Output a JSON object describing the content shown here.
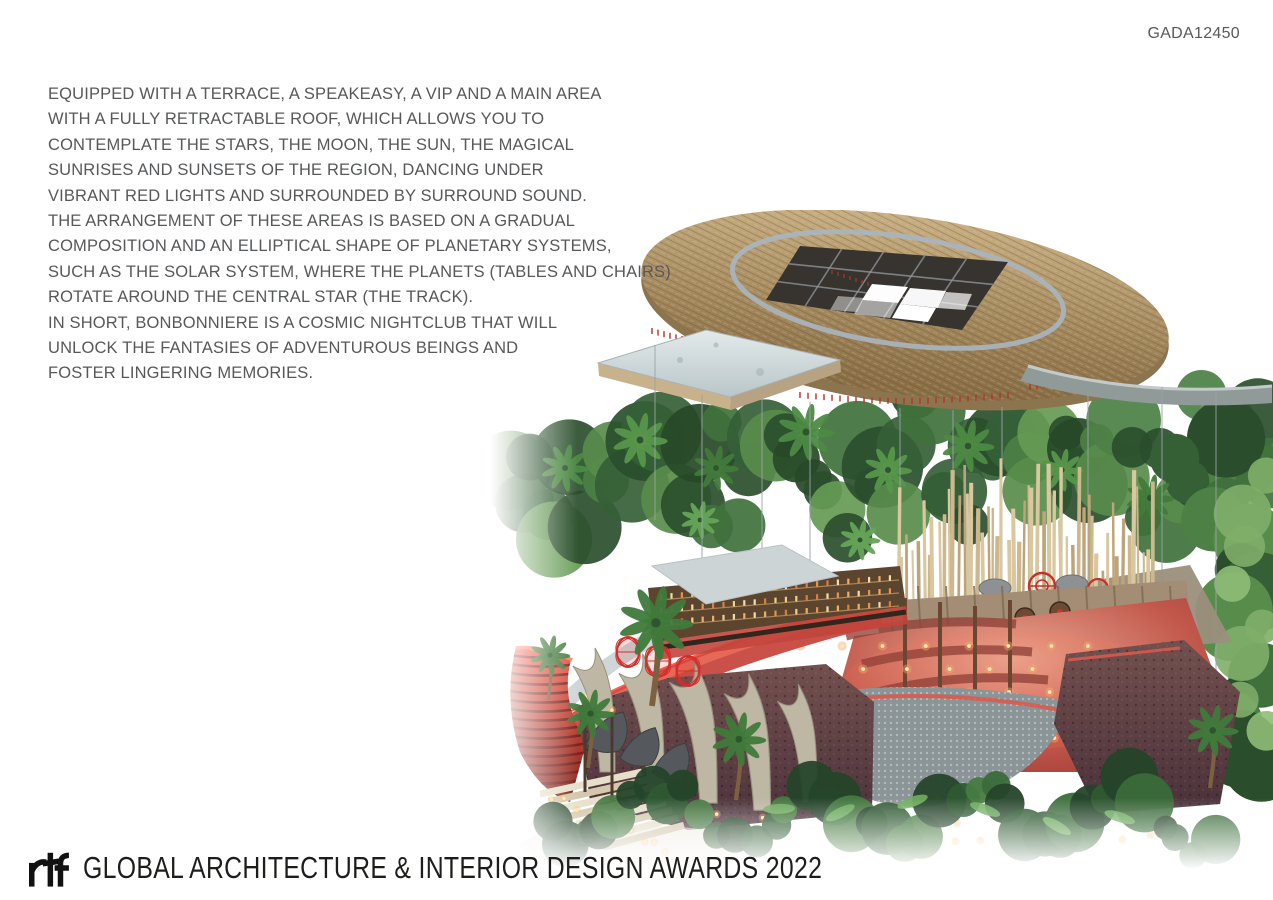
{
  "page": {
    "background": "#ffffff",
    "code": "GADA12450"
  },
  "description": {
    "text_color": "#58595b",
    "lines": [
      "EQUIPPED WITH A TERRACE, A SPEAKEASY, A VIP AND A MAIN AREA",
      "WITH A FULLY RETRACTABLE ROOF, WHICH ALLOWS YOU TO",
      "CONTEMPLATE THE STARS, THE MOON, THE SUN, THE MAGICAL",
      "SUNRISES AND SUNSETS OF THE REGION, DANCING UNDER",
      "VIBRANT RED LIGHTS AND SURROUNDED BY SURROUND SOUND.",
      "THE ARRANGEMENT OF THESE AREAS IS BASED ON A GRADUAL",
      "COMPOSITION AND AN ELLIPTICAL SHAPE OF PLANETARY SYSTEMS,",
      "SUCH AS THE SOLAR SYSTEM, WHERE THE PLANETS (TABLES AND CHAIRS)",
      "ROTATE AROUND THE CENTRAL STAR (THE TRACK).",
      "IN SHORT, BONBONNIERE IS A COSMIC NIGHTCLUB THAT WILL",
      "UNLOCK THE FANTASIES OF ADVENTUROUS BEINGS AND",
      "FOSTER LINGERING MEMORIES."
    ]
  },
  "footer": {
    "logo": "rtf",
    "title": "GLOBAL ARCHITECTURE & INTERIOR DESIGN AWARDS 2022",
    "text_color": "#1d1d1b"
  },
  "artwork": {
    "colors": {
      "thatch_roof": "#b0966c",
      "thatch_shadow": "#8c744f",
      "roof_ring": "#a9b6c0",
      "roof_opening": "#37332f",
      "concrete": "#ccd4d6",
      "jungle_green": "#3f6b3a",
      "accent_red": "#cf2a2a",
      "interior_glow": "#c2453c",
      "stone_wall": "#5c4145",
      "bamboo": "#c9b383",
      "warm_light": "#ffca7a"
    }
  }
}
